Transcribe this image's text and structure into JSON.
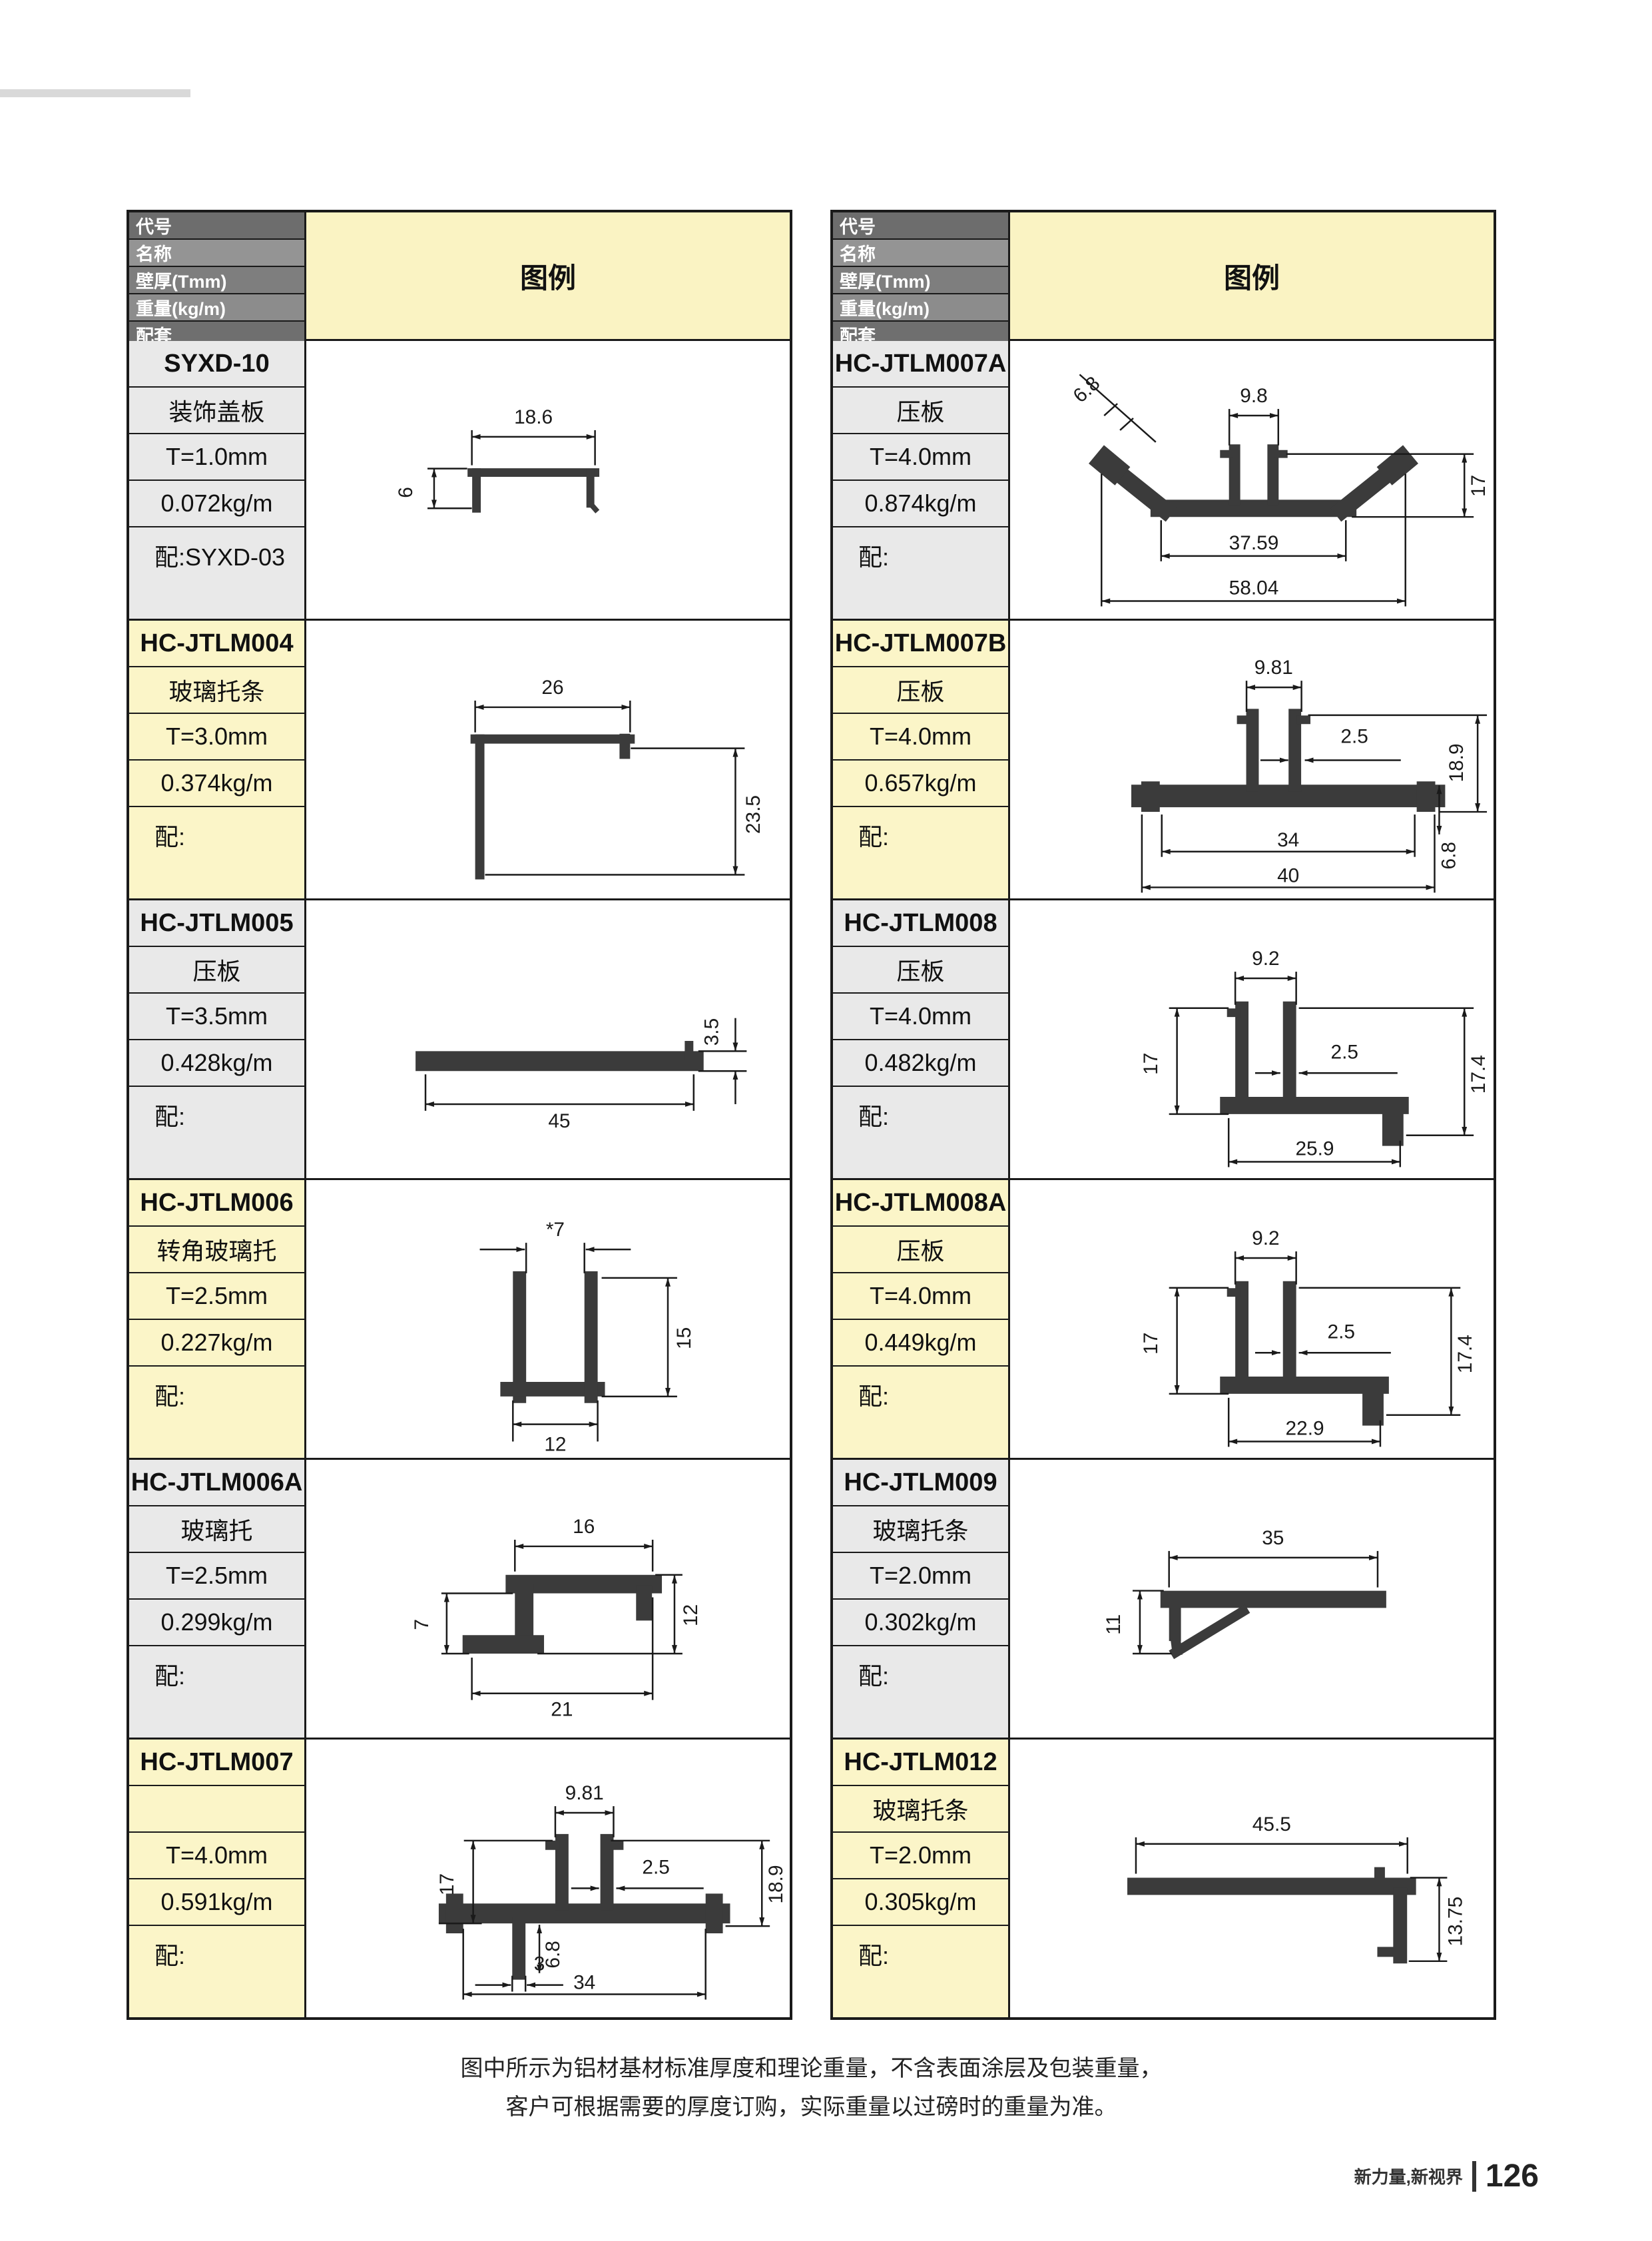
{
  "page": {
    "footer_note_line1": "图中所示为铝材基材标准厚度和理论重量，不含表面涂层及包装重量，",
    "footer_note_line2": "客户可根据需要的厚度订购，实际重量以过磅时的重量为准。",
    "footer_brand": "新力量,新视界",
    "page_number": "126"
  },
  "header": {
    "row_labels": [
      "代号",
      "名称",
      "壁厚(Tmm)",
      "重量(kg/m)",
      "配套"
    ],
    "legend_label": "图例"
  },
  "colors": {
    "yellow_cell": "#fbf5c8",
    "gray_cell": "#e9e9e9",
    "legend_header": "#faf3c3",
    "header_gray_dark": "#6d6d6d",
    "header_gray_light": "#949494",
    "line": "#1a1a1a",
    "profile": "#3b3b3b"
  },
  "tables": [
    {
      "blocks": [
        {
          "code": "SYXD-10",
          "name": "装饰盖板",
          "thickness": "T=1.0mm",
          "weight": "0.072kg/m",
          "match": "配:SYXD-03",
          "dims": {
            "w": "18.6",
            "h": "6"
          }
        },
        {
          "code": "HC-JTLM004",
          "name": "玻璃托条",
          "thickness": "T=3.0mm",
          "weight": "0.374kg/m",
          "match": "配:",
          "dims": {
            "w": "26",
            "h": "23.5"
          }
        },
        {
          "code": "HC-JTLM005",
          "name": "压板",
          "thickness": "T=3.5mm",
          "weight": "0.428kg/m",
          "match": "配:",
          "dims": {
            "t": "3.5",
            "w": "45"
          }
        },
        {
          "code": "HC-JTLM006",
          "name": "转角玻璃托",
          "thickness": "T=2.5mm",
          "weight": "0.227kg/m",
          "match": "配:",
          "dims": {
            "top": "*7",
            "right": "15",
            "bottom": "12"
          }
        },
        {
          "code": "HC-JTLM006A",
          "name": "玻璃托",
          "thickness": "T=2.5mm",
          "weight": "0.299kg/m",
          "match": "配:",
          "dims": {
            "top": "16",
            "left": "7",
            "right": "12",
            "bottom": "21"
          }
        },
        {
          "code": "HC-JTLM007",
          "name": "",
          "thickness": "T=4.0mm",
          "weight": "0.591kg/m",
          "match": "配:",
          "dims": {
            "top": "9.81",
            "gap": "2.5",
            "left": "17",
            "right": "18.9",
            "leg": "3",
            "bottom": "34",
            "leg_len": "6.8"
          }
        }
      ]
    },
    {
      "blocks": [
        {
          "code": "HC-JTLM007A",
          "name": "压板",
          "thickness": "T=4.0mm",
          "weight": "0.874kg/m",
          "match": "配:",
          "dims": {
            "wing": "6.8",
            "top": "9.8",
            "right": "17",
            "inner": "37.59",
            "outer": "58.04"
          }
        },
        {
          "code": "HC-JTLM007B",
          "name": "压板",
          "thickness": "T=4.0mm",
          "weight": "0.657kg/m",
          "match": "配:",
          "dims": {
            "top": "9.81",
            "gap": "2.5",
            "right": "18.9",
            "inner": "34",
            "outer": "40",
            "base": "6.8"
          }
        },
        {
          "code": "HC-JTLM008",
          "name": "压板",
          "thickness": "T=4.0mm",
          "weight": "0.482kg/m",
          "match": "配:",
          "dims": {
            "top": "9.2",
            "left": "17",
            "gap": "2.5",
            "right": "17.4",
            "bottom": "25.9"
          }
        },
        {
          "code": "HC-JTLM008A",
          "name": "压板",
          "thickness": "T=4.0mm",
          "weight": "0.449kg/m",
          "match": "配:",
          "dims": {
            "top": "9.2",
            "left": "17",
            "gap": "2.5",
            "right": "17.4",
            "bottom": "22.9"
          }
        },
        {
          "code": "HC-JTLM009",
          "name": "玻璃托条",
          "thickness": "T=2.0mm",
          "weight": "0.302kg/m",
          "match": "配:",
          "dims": {
            "top": "35",
            "left": "11"
          }
        },
        {
          "code": "HC-JTLM012",
          "name": "玻璃托条",
          "thickness": "T=2.0mm",
          "weight": "0.305kg/m",
          "match": "配:",
          "dims": {
            "top": "45.5",
            "right": "13.75"
          }
        }
      ]
    }
  ]
}
